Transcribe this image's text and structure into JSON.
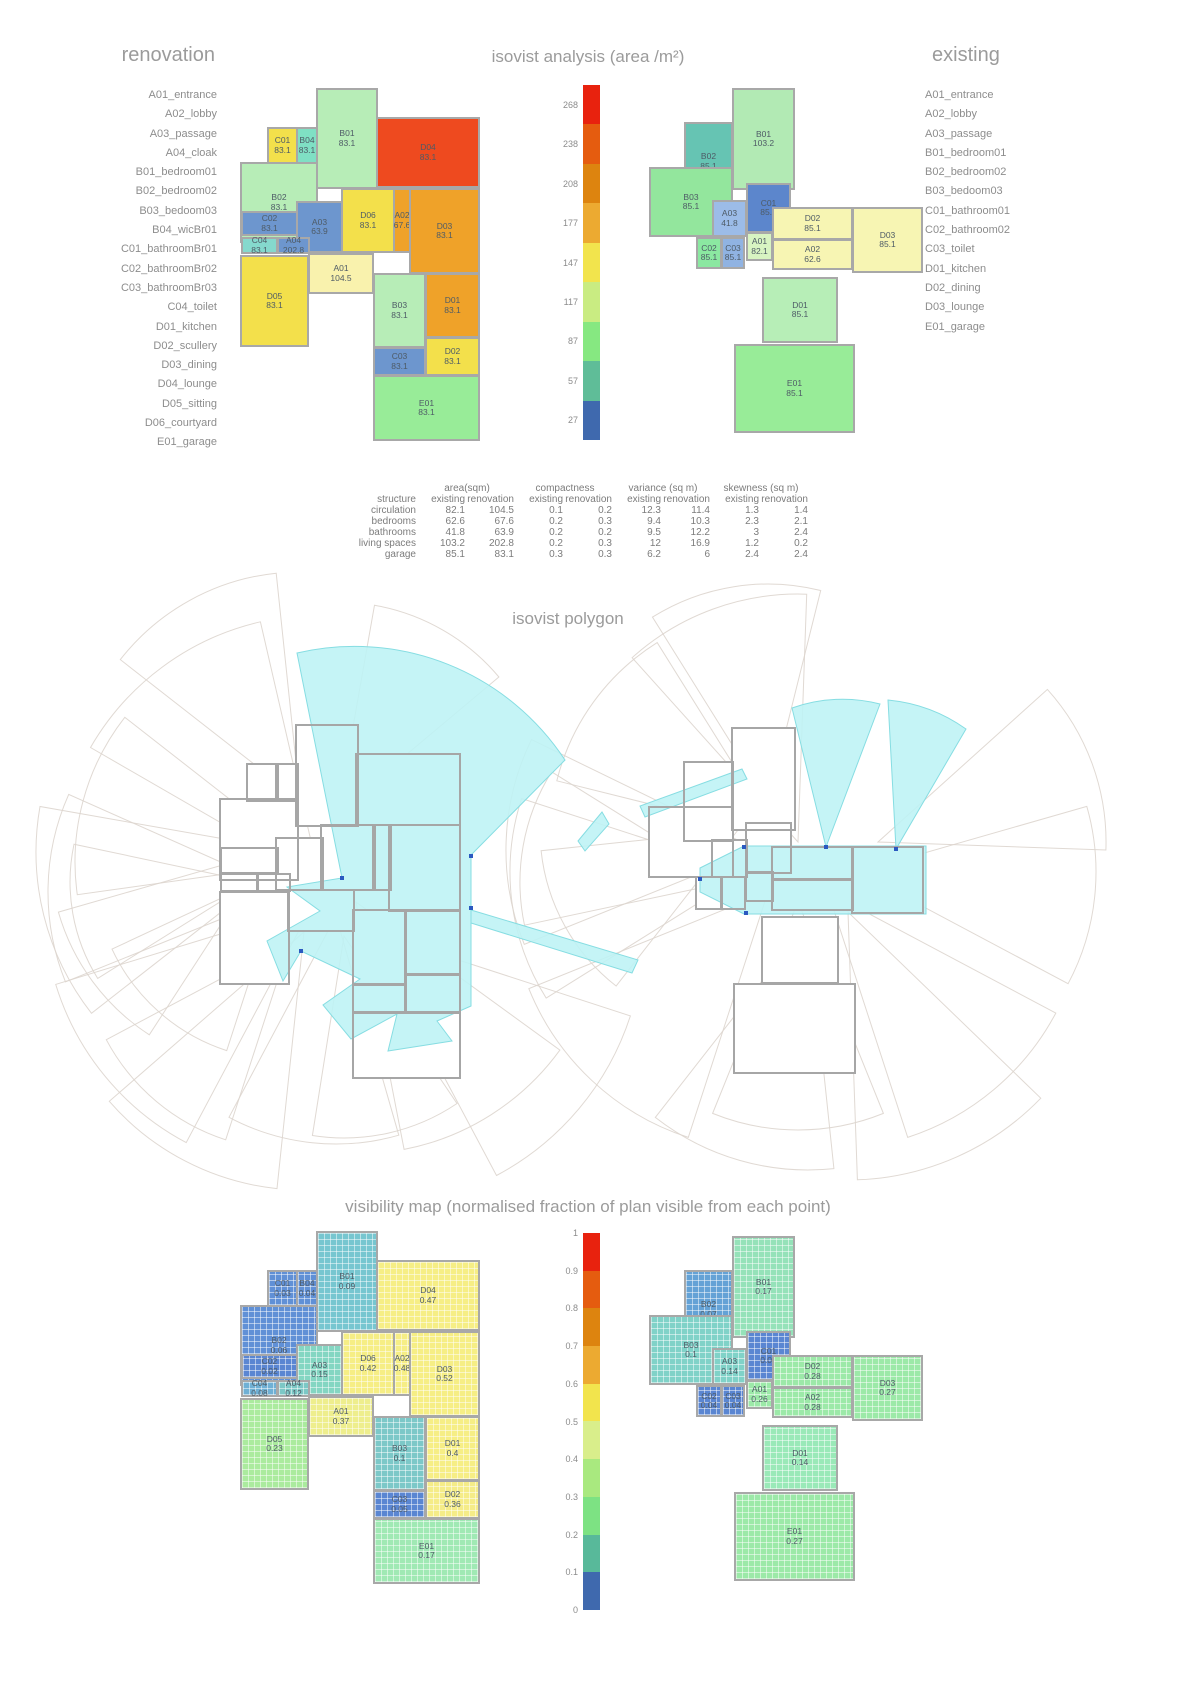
{
  "titles": {
    "isovist": "isovist analysis (area /m²)",
    "polygon": "isovist polygon",
    "visibility": "visibility map (normalised fraction of plan visible from each point)"
  },
  "legend_left": {
    "title": "renovation",
    "items": [
      "A01_entrance",
      "A02_lobby",
      "A03_passage",
      "A04_cloak",
      "B01_bedroom01",
      "B02_bedroom02",
      "B03_bedoom03",
      "B04_wicBr01",
      "C01_bathroomBr01",
      "C02_bathroomBr02",
      "C03_bathroomBr03",
      "C04_toilet",
      "D01_kitchen",
      "D02_scullery",
      "D03_dining",
      "D04_lounge",
      "D05_sitting",
      "D06_courtyard",
      "E01_garage"
    ]
  },
  "legend_right": {
    "title": "existing",
    "items": [
      "A01_entrance",
      "A02_lobby",
      "A03_passage",
      "B01_bedroom01",
      "B02_bedroom02",
      "B03_bedoom03",
      "C01_bathroom01",
      "C02_bathroom02",
      "C03_toilet",
      "D01_kitchen",
      "D02_dining",
      "D03_lounge",
      "E01_garage"
    ]
  },
  "isobar": {
    "x": 583,
    "y": 85,
    "w": 17,
    "h": 355,
    "ticks": [
      "268",
      "238",
      "208",
      "177",
      "147",
      "117",
      "87",
      "57",
      "27"
    ],
    "colors": [
      "#e8220e",
      "#e55c0f",
      "#dd840f",
      "#ecaa31",
      "#f2e44d",
      "#c9ec82",
      "#86e881",
      "#5fbd98",
      "#3f69ae"
    ]
  },
  "visbar": {
    "x": 583,
    "y": 1233,
    "w": 17,
    "h": 377,
    "ticks": [
      "1",
      "0.9",
      "0.8",
      "0.7",
      "0.6",
      "0.5",
      "0.4",
      "0.3",
      "0.2",
      "0.1",
      "0"
    ],
    "colors": [
      "#e8220e",
      "#e55c0f",
      "#dd840f",
      "#ecaa31",
      "#f2e44d",
      "#d9ee8b",
      "#a9e97f",
      "#7de283",
      "#58b99a",
      "#3f69ae"
    ]
  },
  "renovation": {
    "vis_shift": [
      0,
      1143
    ],
    "poly_shift": [
      -20,
      637
    ],
    "rooms": [
      {
        "id": "C01",
        "x": 267,
        "y": 127,
        "w": 31,
        "h": 37,
        "iso": [
          "83.1",
          "#f3e04b"
        ],
        "vis": [
          "0.03",
          "#6090d6"
        ]
      },
      {
        "id": "B04",
        "x": 296,
        "y": 127,
        "w": 22,
        "h": 37,
        "iso": [
          "83.1",
          "#7fe0c4"
        ],
        "vis": [
          "0.04",
          "#6090d6"
        ]
      },
      {
        "id": "B01",
        "x": 316,
        "y": 88,
        "w": 62,
        "h": 101,
        "iso": [
          "83.1",
          "#b7edb7"
        ],
        "vis": [
          "0.09",
          "#77c6d0"
        ]
      },
      {
        "id": "D04",
        "x": 376,
        "y": 117,
        "w": 104,
        "h": 71,
        "iso": [
          "83.1",
          "#ee4a1f"
        ],
        "vis": [
          "0.47",
          "#f6ee85"
        ]
      },
      {
        "id": "B02",
        "x": 240,
        "y": 162,
        "w": 78,
        "h": 81,
        "iso": [
          "83.1",
          "#b7edb7"
        ],
        "vis": [
          "0.06",
          "#6090d6"
        ]
      },
      {
        "id": "A03",
        "x": 296,
        "y": 201,
        "w": 47,
        "h": 52,
        "iso": [
          "63.9",
          "#6d96ce"
        ],
        "vis": [
          "0.15",
          "#84d6c2"
        ]
      },
      {
        "id": "D06",
        "x": 341,
        "y": 188,
        "w": 54,
        "h": 65,
        "iso": [
          "83.1",
          "#f3e04b"
        ],
        "vis": [
          "0.42",
          "#f6ee85"
        ]
      },
      {
        "id": "A02",
        "x": 393,
        "y": 188,
        "w": 18,
        "h": 65,
        "iso": [
          "67.6",
          "#efa229"
        ],
        "vis": [
          "0.48",
          "#f6ee85"
        ]
      },
      {
        "id": "D03",
        "x": 409,
        "y": 188,
        "w": 71,
        "h": 86,
        "iso": [
          "83.1",
          "#efa229"
        ],
        "vis": [
          "0.52",
          "#f6ee85"
        ]
      },
      {
        "id": "C02",
        "x": 241,
        "y": 211,
        "w": 57,
        "h": 25,
        "iso": [
          "83.1",
          "#6d96ce"
        ],
        "vis": [
          "0.02",
          "#5a86d2"
        ]
      },
      {
        "id": "C04",
        "x": 241,
        "y": 237,
        "w": 37,
        "h": 17,
        "iso": [
          "83.1",
          "#85d9cd"
        ],
        "vis": [
          "0.08",
          "#6fb0d4"
        ]
      },
      {
        "id": "A04",
        "x": 277,
        "y": 237,
        "w": 33,
        "h": 17,
        "iso": [
          "202.8",
          "#6d96ce"
        ],
        "vis": [
          "0.12",
          "#7cc8c6"
        ]
      },
      {
        "id": "D05",
        "x": 240,
        "y": 255,
        "w": 69,
        "h": 92,
        "iso": [
          "83.1",
          "#f3e04b"
        ],
        "vis": [
          "0.23",
          "#abeb9e"
        ]
      },
      {
        "id": "A01",
        "x": 308,
        "y": 253,
        "w": 66,
        "h": 41,
        "iso": [
          "104.5",
          "#f9f2ad"
        ],
        "vis": [
          "0.37",
          "#eeee8d"
        ]
      },
      {
        "id": "B03",
        "x": 373,
        "y": 273,
        "w": 53,
        "h": 75,
        "iso": [
          "83.1",
          "#b7edb7"
        ],
        "vis": [
          "0.1",
          "#7cc8c8"
        ]
      },
      {
        "id": "D01",
        "x": 425,
        "y": 273,
        "w": 55,
        "h": 65,
        "iso": [
          "83.1",
          "#efa229"
        ],
        "vis": [
          "0.4",
          "#f6ee85"
        ]
      },
      {
        "id": "D02",
        "x": 425,
        "y": 337,
        "w": 55,
        "h": 39,
        "iso": [
          "83.1",
          "#f3e04b"
        ],
        "vis": [
          "0.36",
          "#f5ec88"
        ]
      },
      {
        "id": "C03",
        "x": 373,
        "y": 347,
        "w": 53,
        "h": 29,
        "iso": [
          "83.1",
          "#6d96ce"
        ],
        "vis": [
          "0.05",
          "#5a86d2"
        ]
      },
      {
        "id": "E01",
        "x": 373,
        "y": 375,
        "w": 107,
        "h": 66,
        "iso": [
          "83.1",
          "#98ec98"
        ],
        "vis": [
          "0.17",
          "#a0e9b4"
        ]
      }
    ]
  },
  "existing": {
    "vis_shift": [
      0,
      1148
    ],
    "poly_shift": [
      0,
      640
    ],
    "rooms": [
      {
        "id": "B01",
        "x": 732,
        "y": 88,
        "w": 63,
        "h": 102,
        "iso": [
          "103.2",
          "#b2eab4"
        ],
        "vis": [
          "0.17",
          "#95e2b9"
        ]
      },
      {
        "id": "B02",
        "x": 684,
        "y": 122,
        "w": 49,
        "h": 79,
        "iso": [
          "85.1",
          "#66c4b3"
        ],
        "vis": [
          "0.07",
          "#64a2d6"
        ]
      },
      {
        "id": "B03",
        "x": 649,
        "y": 167,
        "w": 84,
        "h": 70,
        "iso": [
          "85.1",
          "#93e69d"
        ],
        "vis": [
          "0.1",
          "#80d2c8"
        ]
      },
      {
        "id": "A03",
        "x": 712,
        "y": 200,
        "w": 35,
        "h": 37,
        "iso": [
          "41.8",
          "#9cbce8"
        ],
        "vis": [
          "0.14",
          "#80d2c8"
        ]
      },
      {
        "id": "C01",
        "x": 746,
        "y": 183,
        "w": 45,
        "h": 50,
        "iso": [
          "85.1",
          "#5c86cc"
        ],
        "vis": [
          "0.04",
          "#5a86d2"
        ]
      },
      {
        "id": "C02",
        "x": 696,
        "y": 237,
        "w": 26,
        "h": 32,
        "iso": [
          "85.1",
          "#8be8a1"
        ],
        "vis": [
          "0.04",
          "#5a86d2"
        ]
      },
      {
        "id": "C03",
        "x": 721,
        "y": 237,
        "w": 24,
        "h": 32,
        "iso": [
          "85.1",
          "#90b3e2"
        ],
        "vis": [
          "0.04",
          "#5a86d2"
        ]
      },
      {
        "id": "A01",
        "x": 746,
        "y": 232,
        "w": 27,
        "h": 29,
        "iso": [
          "82.1",
          "#d8f4c2"
        ],
        "vis": [
          "0.26",
          "#9ce9a8"
        ]
      },
      {
        "id": "D02",
        "x": 772,
        "y": 207,
        "w": 81,
        "h": 33,
        "iso": [
          "85.1",
          "#f7f5b3"
        ],
        "vis": [
          "0.28",
          "#9ce9a8"
        ]
      },
      {
        "id": "D03",
        "x": 852,
        "y": 207,
        "w": 71,
        "h": 66,
        "iso": [
          "85.1",
          "#f7f5b3"
        ],
        "vis": [
          "0.27",
          "#9ce9a8"
        ]
      },
      {
        "id": "A02",
        "x": 772,
        "y": 239,
        "w": 81,
        "h": 31,
        "iso": [
          "62.6",
          "#f7f5b3"
        ],
        "vis": [
          "0.28",
          "#9ce9a8"
        ]
      },
      {
        "id": "D01",
        "x": 762,
        "y": 277,
        "w": 76,
        "h": 66,
        "iso": [
          "85.1",
          "#b7eeb7"
        ],
        "vis": [
          "0.14",
          "#9ae9b8"
        ]
      },
      {
        "id": "E01",
        "x": 734,
        "y": 344,
        "w": 121,
        "h": 89,
        "iso": [
          "85.1",
          "#98ec98"
        ],
        "vis": [
          "0.27",
          "#9ce9a8"
        ]
      }
    ]
  },
  "table": {
    "groups": [
      "area(sqm)",
      "compactness",
      "variance (sq m)",
      "skewness (sq m)"
    ],
    "subheader": [
      "structure",
      "existing",
      "renovation",
      "existing",
      "renovation",
      "existing",
      "renovation",
      "existing",
      "renovation"
    ],
    "rows": [
      [
        "circulation",
        "82.1",
        "104.5",
        "0.1",
        "0.2",
        "12.3",
        "11.4",
        "1.3",
        "1.4"
      ],
      [
        "bedrooms",
        "62.6",
        "67.6",
        "0.2",
        "0.3",
        "9.4",
        "10.3",
        "2.3",
        "2.1"
      ],
      [
        "bathrooms",
        "41.8",
        "63.9",
        "0.2",
        "0.2",
        "9.5",
        "12.2",
        "3",
        "2.4"
      ],
      [
        "living spaces",
        "103.2",
        "202.8",
        "0.2",
        "0.3",
        "12",
        "16.9",
        "1.2",
        "0.2"
      ],
      [
        "garage",
        "85.1",
        "83.1",
        "0.3",
        "0.3",
        "6.2",
        "6",
        "2.4",
        "2.4"
      ]
    ]
  },
  "polygon": {
    "fans_left": [
      [
        320,
        880,
        265,
        -150,
        -103
      ],
      [
        310,
        862,
        235,
        -188,
        -142
      ],
      [
        298,
        852,
        262,
        -218,
        -170
      ],
      [
        288,
        892,
        240,
        158,
        204
      ],
      [
        312,
        906,
        268,
        118,
        163
      ],
      [
        336,
        916,
        228,
        74,
        118
      ],
      [
        356,
        902,
        252,
        36,
        79
      ],
      [
        286,
        868,
        192,
        -252,
        -205
      ],
      [
        304,
        932,
        258,
        96,
        139
      ],
      [
        268,
        852,
        218,
        -237,
        -196
      ],
      [
        344,
        936,
        202,
        56,
        99
      ],
      [
        252,
        882,
        182,
        148,
        192
      ],
      [
        300,
        800,
        228,
        -142,
        -96
      ],
      [
        366,
        930,
        278,
        18,
        62
      ],
      [
        290,
        942,
        208,
        108,
        152
      ],
      [
        338,
        812,
        210,
        -80,
        -40
      ]
    ],
    "fans_right": [
      [
        798,
        842,
        248,
        -132,
        -88
      ],
      [
        778,
        836,
        228,
        -166,
        -122
      ],
      [
        758,
        850,
        252,
        -202,
        -154
      ],
      [
        748,
        872,
        238,
        148,
        198
      ],
      [
        768,
        892,
        258,
        108,
        158
      ],
      [
        798,
        902,
        228,
        68,
        112
      ],
      [
        828,
        892,
        258,
        28,
        72
      ],
      [
        858,
        872,
        238,
        -16,
        28
      ],
      [
        738,
        830,
        198,
        -232,
        -186
      ],
      [
        808,
        922,
        248,
        84,
        128
      ],
      [
        728,
        882,
        208,
        168,
        212
      ],
      [
        848,
        912,
        268,
        44,
        88
      ],
      [
        768,
        802,
        218,
        -122,
        -76
      ],
      [
        878,
        842,
        228,
        -42,
        2
      ]
    ],
    "cyan": [
      "M342,878 L297,653 A252,252 0 0 1 565,760 L471,855 L471,1006 L437,1021 L452,1041 L388,1051 L397,1014 L351,1039 L323,1005 L360,979 L301,951 L283,981 L267,941 L320,911 L287,887 Z",
      "M471,910 L638,960 L632,973 L471,923 Z",
      "M826,847 L792,708 A150,150 0 0 1 880,704 Z",
      "M896,849 L888,700 A160,160 0 0 1 966,729 Z",
      "M700,868 L744,846 L926,846 L926,914 L744,914 L700,892 Z",
      "M742,769 L640,806 L645,817 L747,779 Z",
      "M578,841 L602,812 L609,824 L585,851 Z"
    ],
    "markers": [
      [
        342,
        878
      ],
      [
        471,
        856
      ],
      [
        471,
        908
      ],
      [
        301,
        951
      ],
      [
        826,
        847
      ],
      [
        896,
        849
      ],
      [
        744,
        847
      ],
      [
        746,
        913
      ],
      [
        700,
        879
      ]
    ]
  }
}
